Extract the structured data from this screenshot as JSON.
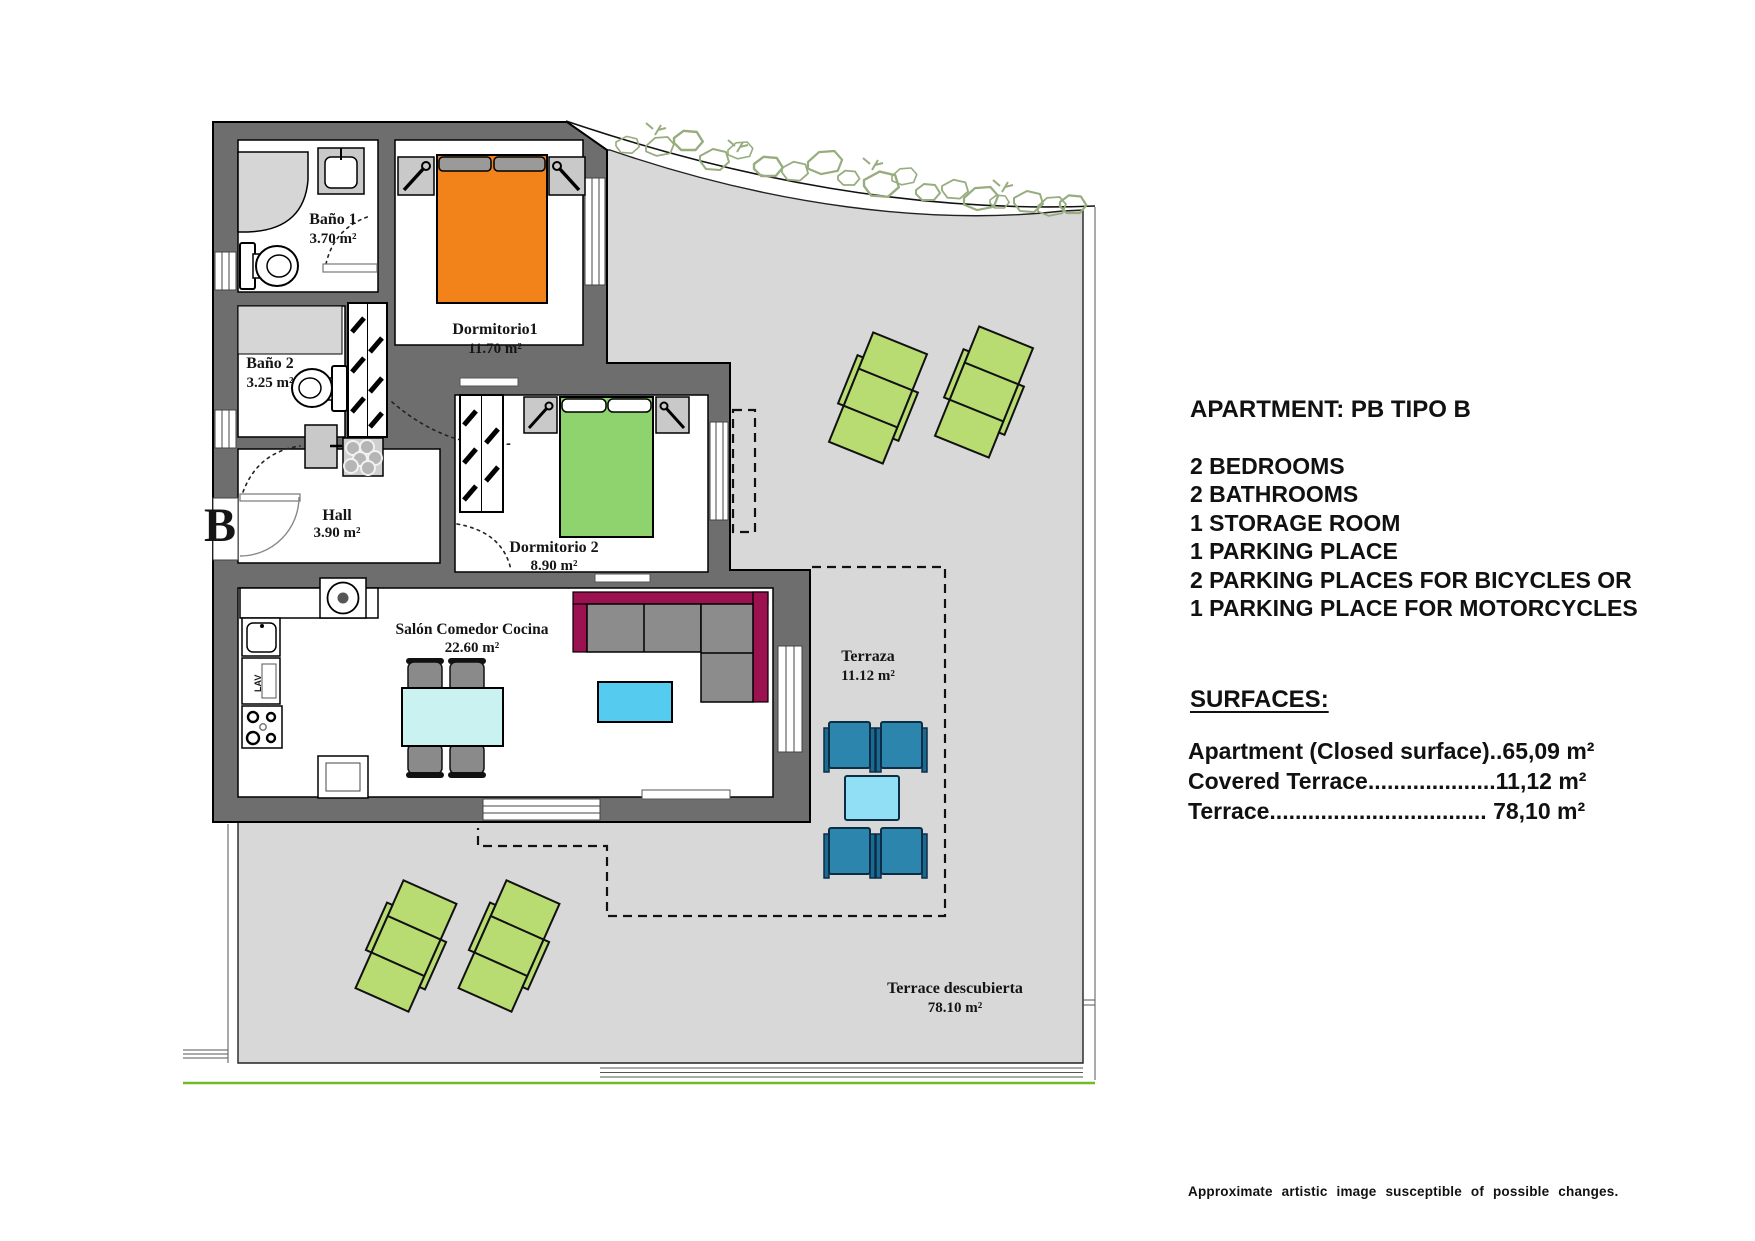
{
  "plan": {
    "unit_label": "B",
    "rooms": {
      "bano1": {
        "name": "Baño 1",
        "area": "3.70 m²"
      },
      "bano2": {
        "name": "Baño 2",
        "area": "3.25 m²"
      },
      "dormitorio1": {
        "name": "Dormitorio1",
        "area": "11.70 m²"
      },
      "dormitorio2": {
        "name": "Dormitorio 2",
        "area": "8.90 m²"
      },
      "hall": {
        "name": "Hall",
        "area": "3.90 m²"
      },
      "salon": {
        "name": "Salón Comedor Cocina",
        "area": "22.60 m²"
      },
      "terraza": {
        "name": "Terraza",
        "area": "11.12 m²"
      },
      "terrace_open": {
        "name": "Terrace descubierta",
        "area": "78.10 m²"
      }
    },
    "labels": {
      "dishwasher": "LAV"
    },
    "colors": {
      "wall": "#6e6e6e",
      "terrace": "#d8d8d8",
      "light_fixture": "#d6d6d6",
      "bed_orange": "#f2831b",
      "bed_green": "#8fd36f",
      "lounger_green": "#b9dc72",
      "chair_blue": "#2b85ad",
      "terrace_table_cyan": "#90dff5",
      "dining_table_cyan": "#c9f2f0",
      "coffee_table_cyan": "#55cbf0",
      "sofa_magenta": "#9c1150",
      "cushion_gray": "#8c8c8c",
      "rockery_green": "#97ad7f",
      "grass_line_green": "#76b82a"
    }
  },
  "info_panel": {
    "title": "APARTMENT: PB TIPO B",
    "features": [
      "2 BEDROOMS",
      "2 BATHROOMS",
      "1 STORAGE ROOM",
      "1 PARKING PLACE",
      "2 PARKING PLACES FOR BICYCLES OR",
      "1 PARKING PLACE FOR MOTORCYCLES"
    ],
    "surfaces_heading": "SURFACES:",
    "surfaces": [
      "Apartment (Closed surface)..65,09 m²",
      "Covered Terrace....................11,12 m²",
      "Terrace.................................. 78,10 m²"
    ]
  },
  "footer": {
    "disclaimer": "Approximate  artistic  image  susceptible  of  possible  changes."
  }
}
